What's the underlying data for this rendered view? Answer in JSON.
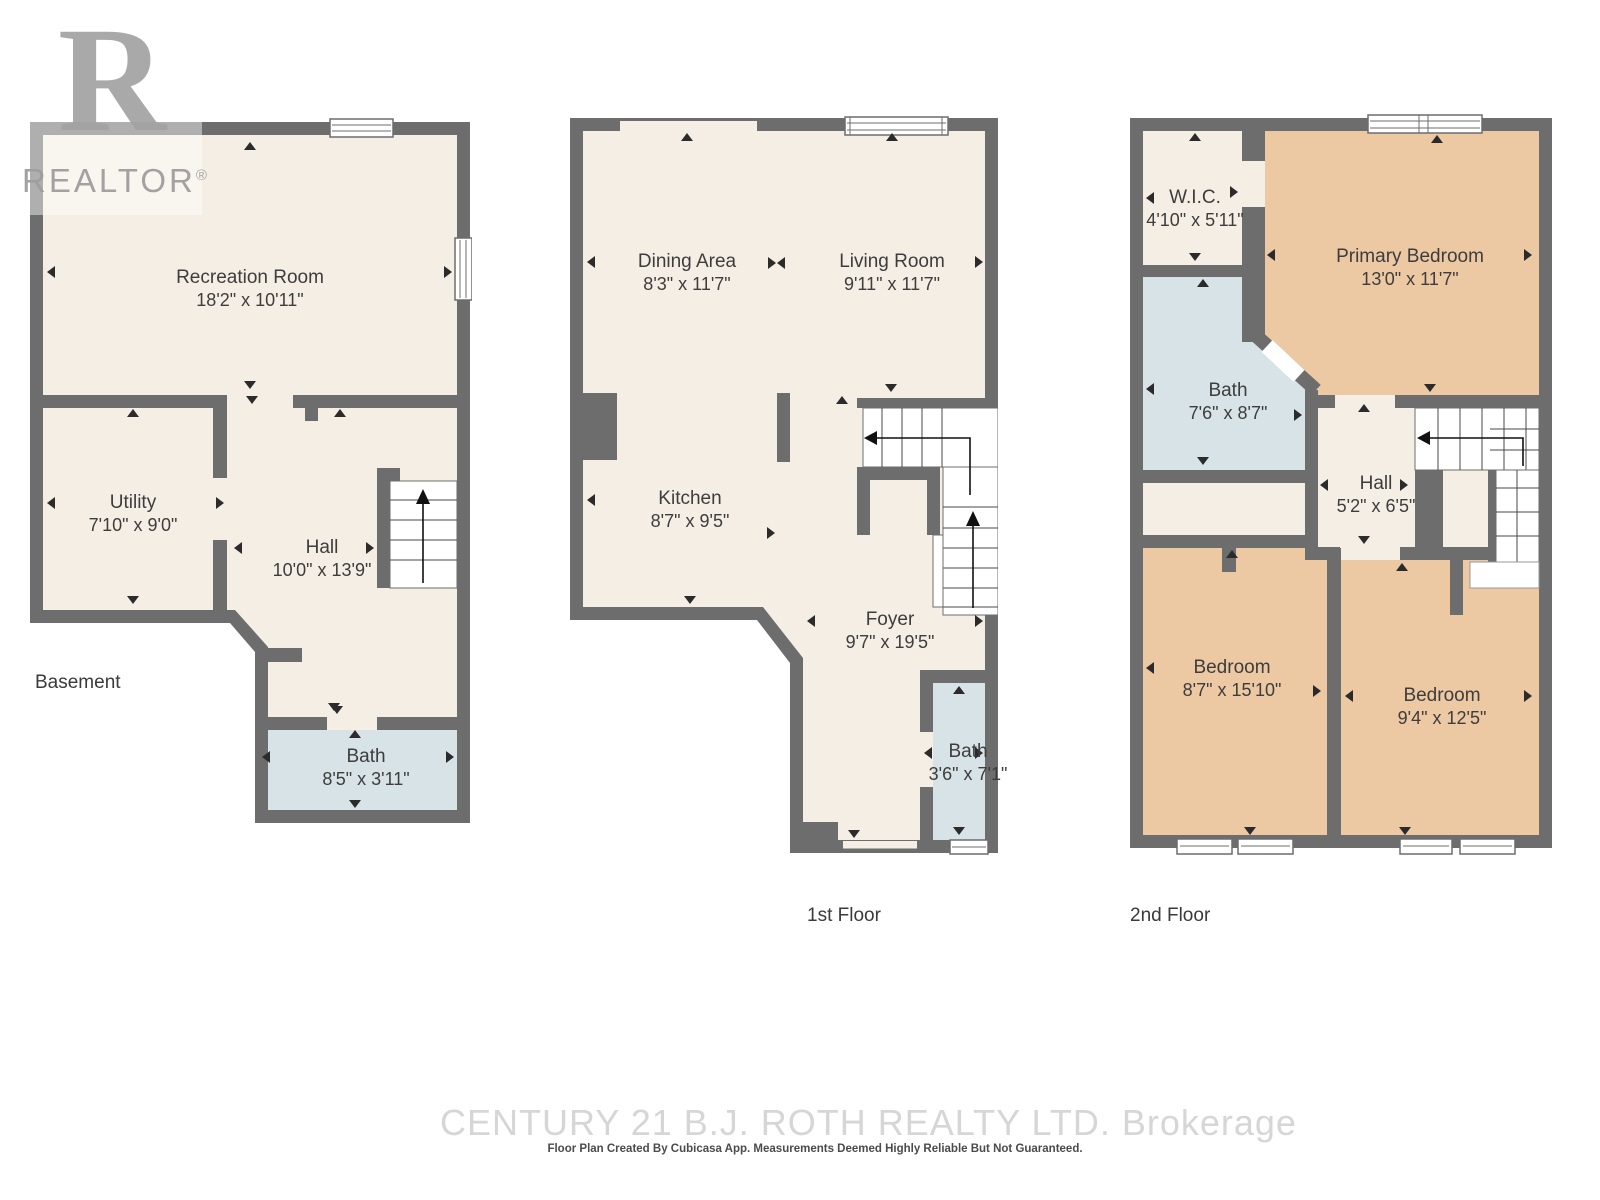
{
  "branding": {
    "logo_letter": "R",
    "logo_word": "REALTOR",
    "logo_reg": "®"
  },
  "floors": [
    {
      "label": "Basement",
      "rooms": [
        {
          "name": "Recreation Room",
          "dims": "18'2\" x 10'11\""
        },
        {
          "name": "Utility",
          "dims": "7'10\" x 9'0\""
        },
        {
          "name": "Hall",
          "dims": "10'0\" x 13'9\""
        },
        {
          "name": "Bath",
          "dims": "8'5\" x 3'11\""
        }
      ]
    },
    {
      "label": "1st Floor",
      "rooms": [
        {
          "name": "Dining Area",
          "dims": "8'3\" x 11'7\""
        },
        {
          "name": "Living Room",
          "dims": "9'11\" x 11'7\""
        },
        {
          "name": "Kitchen",
          "dims": "8'7\" x 9'5\""
        },
        {
          "name": "Foyer",
          "dims": "9'7\" x 19'5\""
        },
        {
          "name": "Bath",
          "dims": "3'6\" x 7'1\""
        }
      ]
    },
    {
      "label": "2nd Floor",
      "rooms": [
        {
          "name": "W.I.C.",
          "dims": "4'10\" x 5'11\""
        },
        {
          "name": "Primary Bedroom",
          "dims": "13'0\" x 11'7\""
        },
        {
          "name": "Bath",
          "dims": "7'6\" x 8'7\""
        },
        {
          "name": "Hall",
          "dims": "5'2\" x 6'5\""
        },
        {
          "name": "Bedroom",
          "dims": "8'7\" x 15'10\""
        },
        {
          "name": "Bedroom",
          "dims": "9'4\" x 12'5\""
        }
      ]
    }
  ],
  "watermark": {
    "brokerage": "CENTURY 21 B.J. ROTH REALTY LTD.  Brokerage",
    "disclaimer": "Floor Plan Created By Cubicasa App. Measurements Deemed Highly Reliable But Not Guaranteed."
  },
  "colors": {
    "wall": "#6d6d6d",
    "floor": "#f5eee4",
    "bath": "#d7e3e6",
    "bedroom": "#ecc8a3"
  }
}
